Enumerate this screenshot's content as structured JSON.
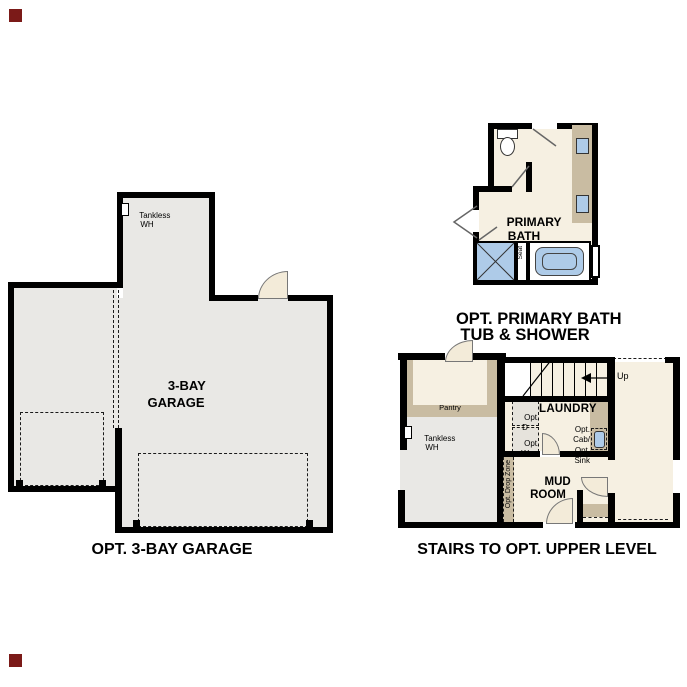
{
  "garage_plan": {
    "room_label_line1": "3-BAY",
    "room_label_line2": "GARAGE",
    "tankless_line1": "Tankless",
    "tankless_line2": "WH",
    "caption": "OPT. 3-BAY GARAGE"
  },
  "bath_plan": {
    "room_label_line1": "PRIMARY",
    "room_label_line2": "BATH",
    "seat_label": "Seat",
    "caption_line1": "OPT. PRIMARY BATH",
    "caption_line2": "TUB & SHOWER"
  },
  "stairs_plan": {
    "pantry_label": "Pantry",
    "tankless_line1": "Tankless",
    "tankless_line2": "WH",
    "laundry_label": "LAUNDRY",
    "opt_dryer_line1": "Opt.",
    "opt_dryer_line2": "D",
    "opt_washer_line1": "Opt.",
    "opt_washer_line2": "W",
    "opt_cab_line1": "Opt.",
    "opt_cab_line2": "Cab/",
    "opt_sink_line1": "Opt.",
    "opt_sink_line2": "Sink",
    "up_label": "Up",
    "mud_room_line1": "MUD",
    "mud_room_line2": "ROOM",
    "drop_zone_label": "Opt. Drop Zone",
    "caption": "STAIRS TO OPT. UPPER LEVEL"
  },
  "colors": {
    "wall": "#000000",
    "gray": "#e9e8e5",
    "cream": "#f6f0e2",
    "tan": "#c9bca2",
    "blue": "#aecbe8",
    "fan": "#f3ebd9",
    "mark": "#7b1a18"
  }
}
